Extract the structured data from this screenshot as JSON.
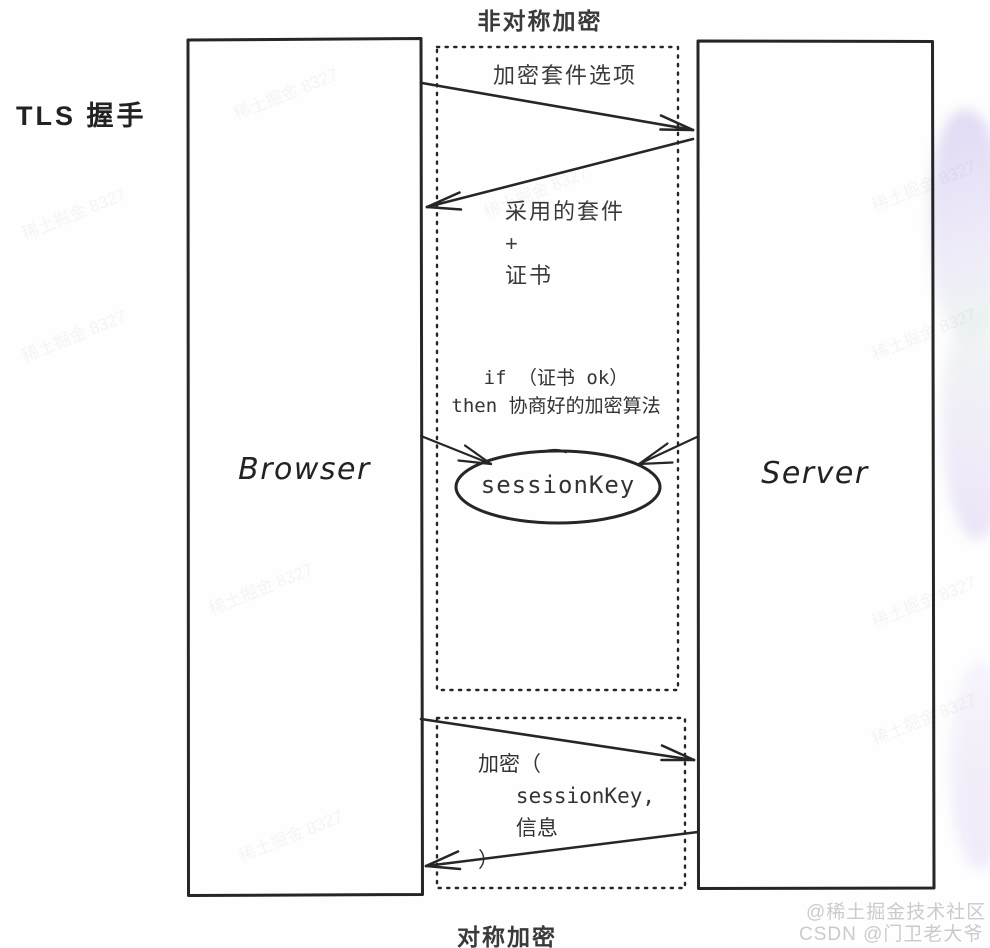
{
  "diagram": {
    "title_top": "非对称加密",
    "title_bottom": "对称加密",
    "side_label": "TLS 握手",
    "nodes": {
      "browser": "Browser",
      "server": "Server",
      "session_key": "sessionKey"
    },
    "messages": {
      "cipher_options": "加密套件选项",
      "adopted_suite": "采用的套件\n+\n证书",
      "if_then": "if （证书 ok）\nthen 协商好的加密算法",
      "encrypt_call": "加密（\n   sessionKey,\n   信息\n）"
    },
    "watermark": {
      "line1": "@稀土掘金技术社区",
      "line2": "CSDN @门卫老大爷",
      "faint": "稀土掘金 8327"
    },
    "colors": {
      "ink": "#2b2b2b",
      "watermark_gray": "#cbcbcb",
      "blob_lavender": "#d5ccf0",
      "blob_mint": "#eaf4ec"
    }
  }
}
